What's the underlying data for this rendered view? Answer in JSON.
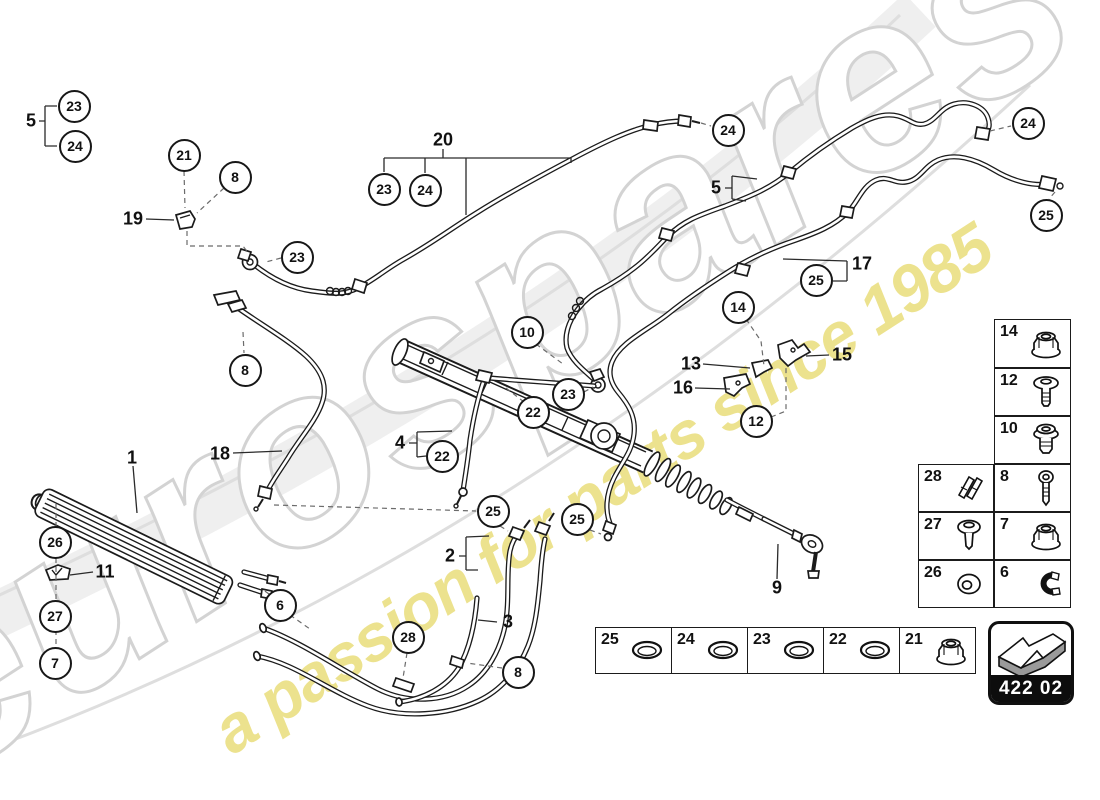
{
  "watermark": {
    "brand": "eurospares",
    "tagline": "a passion for parts since 1985",
    "brand_outline_color": "#d3d3d3",
    "tagline_color": "#e8db72"
  },
  "part_code": {
    "label": "422 02"
  },
  "callouts": {
    "circles": [
      {
        "label": "23",
        "x": 74,
        "y": 106
      },
      {
        "label": "24",
        "x": 75,
        "y": 146
      },
      {
        "label": "21",
        "x": 184,
        "y": 155
      },
      {
        "label": "8",
        "x": 235,
        "y": 177
      },
      {
        "label": "23",
        "x": 297,
        "y": 257
      },
      {
        "label": "8",
        "x": 245,
        "y": 370
      },
      {
        "label": "23",
        "x": 384,
        "y": 189
      },
      {
        "label": "24",
        "x": 425,
        "y": 190
      },
      {
        "label": "24",
        "x": 728,
        "y": 130
      },
      {
        "label": "24",
        "x": 1028,
        "y": 123
      },
      {
        "label": "25",
        "x": 1046,
        "y": 215
      },
      {
        "label": "25",
        "x": 816,
        "y": 280
      },
      {
        "label": "14",
        "x": 738,
        "y": 307
      },
      {
        "label": "12",
        "x": 756,
        "y": 421
      },
      {
        "label": "10",
        "x": 527,
        "y": 332
      },
      {
        "label": "23",
        "x": 568,
        "y": 394
      },
      {
        "label": "22",
        "x": 533,
        "y": 412
      },
      {
        "label": "22",
        "x": 442,
        "y": 456
      },
      {
        "label": "26",
        "x": 55,
        "y": 542
      },
      {
        "label": "27",
        "x": 55,
        "y": 616
      },
      {
        "label": "7",
        "x": 55,
        "y": 663
      },
      {
        "label": "6",
        "x": 280,
        "y": 605
      },
      {
        "label": "28",
        "x": 408,
        "y": 637
      },
      {
        "label": "8",
        "x": 518,
        "y": 672
      },
      {
        "label": "25",
        "x": 493,
        "y": 511
      },
      {
        "label": "25",
        "x": 577,
        "y": 519
      }
    ],
    "labels": [
      {
        "label": "5",
        "x": 31,
        "y": 121
      },
      {
        "label": "19",
        "x": 133,
        "y": 219
      },
      {
        "label": "20",
        "x": 443,
        "y": 140
      },
      {
        "label": "5",
        "x": 716,
        "y": 188
      },
      {
        "label": "17",
        "x": 862,
        "y": 264
      },
      {
        "label": "13",
        "x": 691,
        "y": 364
      },
      {
        "label": "16",
        "x": 683,
        "y": 388
      },
      {
        "label": "15",
        "x": 842,
        "y": 355
      },
      {
        "label": "4",
        "x": 400,
        "y": 443
      },
      {
        "label": "1",
        "x": 132,
        "y": 458
      },
      {
        "label": "18",
        "x": 220,
        "y": 454
      },
      {
        "label": "11",
        "x": 105,
        "y": 572
      },
      {
        "label": "3",
        "x": 508,
        "y": 622
      },
      {
        "label": "2",
        "x": 450,
        "y": 556
      },
      {
        "label": "9",
        "x": 777,
        "y": 588
      }
    ]
  },
  "legend_right": {
    "cells": [
      {
        "num": "14",
        "icon": "flange-nut-icon",
        "x": 994,
        "y": 319,
        "w": 77,
        "h": 49
      },
      {
        "num": "12",
        "icon": "washer-screw-icon",
        "x": 994,
        "y": 368,
        "w": 77,
        "h": 48
      },
      {
        "num": "10",
        "icon": "flange-bolt-icon",
        "x": 994,
        "y": 416,
        "w": 77,
        "h": 48
      },
      {
        "num": "28",
        "icon": "spring-clip-icon",
        "x": 918,
        "y": 464,
        "w": 76,
        "h": 48
      },
      {
        "num": "8",
        "icon": "screw-icon",
        "x": 994,
        "y": 464,
        "w": 77,
        "h": 48
      },
      {
        "num": "27",
        "icon": "dome-screw-icon",
        "x": 918,
        "y": 512,
        "w": 76,
        "h": 48
      },
      {
        "num": "7",
        "icon": "flange-nut-icon",
        "x": 994,
        "y": 512,
        "w": 77,
        "h": 48
      },
      {
        "num": "26",
        "icon": "washer-icon",
        "x": 918,
        "y": 560,
        "w": 76,
        "h": 48
      },
      {
        "num": "6",
        "icon": "clamp-icon",
        "x": 994,
        "y": 560,
        "w": 77,
        "h": 48
      }
    ]
  },
  "legend_bottom": {
    "cells": [
      {
        "num": "25",
        "icon": "seal-ring-icon",
        "x": 595,
        "y": 627,
        "w": 77,
        "h": 47
      },
      {
        "num": "24",
        "icon": "seal-ring-icon",
        "x": 671,
        "y": 627,
        "w": 77,
        "h": 47
      },
      {
        "num": "23",
        "icon": "seal-ring-icon",
        "x": 747,
        "y": 627,
        "w": 77,
        "h": 47
      },
      {
        "num": "22",
        "icon": "seal-ring-icon",
        "x": 823,
        "y": 627,
        "w": 77,
        "h": 47
      },
      {
        "num": "21",
        "icon": "flange-nut-icon",
        "x": 899,
        "y": 627,
        "w": 77,
        "h": 47
      }
    ]
  }
}
